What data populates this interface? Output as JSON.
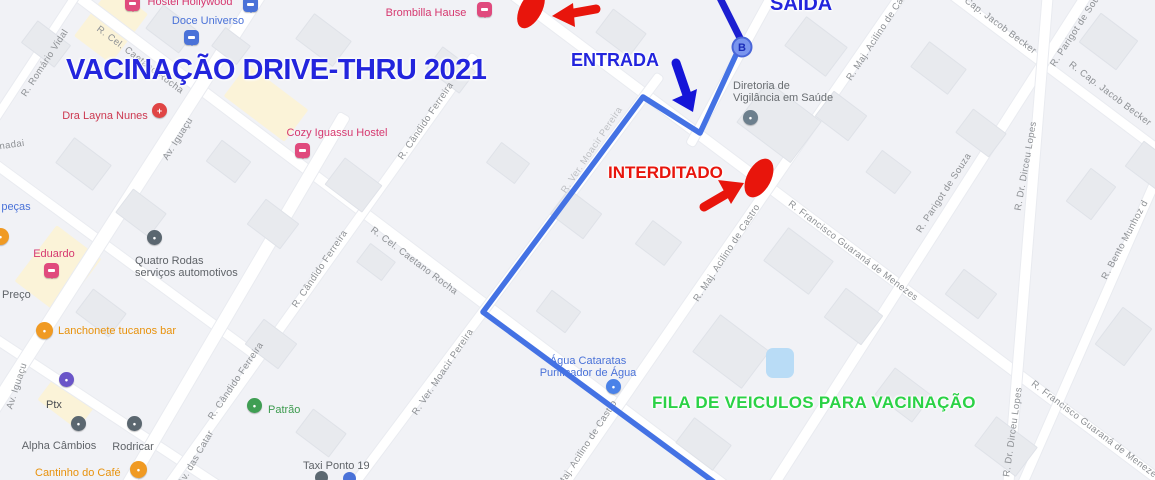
{
  "annotations": {
    "title": "VACINAÇÃO DRIVE-THRU 2021",
    "saida": "SAÍDA",
    "entrada": "ENTRADA",
    "interditado": "INTERDITADO",
    "fila": "FILA DE VEICULOS PARA VACINAÇÃO",
    "blue": "#2325dd",
    "red": "#e8150c",
    "green": "#2bd246"
  },
  "route": {
    "marker_label": "B",
    "marker_x": "742",
    "marker_y": "47",
    "dark_points": "718,-6 741,40",
    "light_points": "741,44 700,133 643,97 483,312 722,488",
    "dark_color": "#1c1fd1",
    "light_color": "#4472e4",
    "marker_fill": "#7a95ee",
    "marker_stroke": "#4a66d8",
    "marker_text_color": "#1b2cb8",
    "blue_arrow_shaft": "676,63 687,95",
    "blue_arrow_head": "693,112 672,100 697,89",
    "red_arrow1_shaft": "596,9 568,14",
    "red_arrow1_head": "552,16 573,3 575,27",
    "red_arrow2_shaft": "704,207 728,193",
    "red_arrow2_head": "744,183 718,180 731,204",
    "blob1_transform": "rotate(28 531 9)",
    "blob2_transform": "rotate(28 759 178)"
  },
  "streets": [
    {
      "label": "R. Romário Vidal",
      "x": 45,
      "y": 63,
      "rot": -57
    },
    {
      "label": "nadai",
      "x": 12,
      "y": 145,
      "rot": -8
    },
    {
      "label": "R. Cel. Caetano Rocha",
      "x": 140,
      "y": 60,
      "rot": 37
    },
    {
      "label": "R. Cel. Caetano Rocha",
      "x": 414,
      "y": 261,
      "rot": 37
    },
    {
      "label": "Av. Iguaçu",
      "x": 178,
      "y": 139,
      "rot": -58
    },
    {
      "label": "Av. Iguaçu",
      "x": 17,
      "y": 386,
      "rot": -72
    },
    {
      "label": "Av. das Catar",
      "x": 196,
      "y": 458,
      "rot": -60
    },
    {
      "label": "R. Cândido Ferreira",
      "x": 426,
      "y": 121,
      "rot": -56
    },
    {
      "label": "R. Cândido Ferreira",
      "x": 320,
      "y": 269,
      "rot": -56
    },
    {
      "label": "R. Cândido Ferreira",
      "x": 236,
      "y": 381,
      "rot": -56
    },
    {
      "label": "R. Ver. Moacir Pereira",
      "x": 443,
      "y": 372,
      "rot": -56
    },
    {
      "label": "R. Ver. Moacir Pereira",
      "x": 592,
      "y": 150,
      "rot": -56,
      "faint": true
    },
    {
      "label": "R. Maj. Acilino de Castro",
      "x": 880,
      "y": 32,
      "rot": -57
    },
    {
      "label": "R. Maj. Acilino de Castro",
      "x": 727,
      "y": 253,
      "rot": -57
    },
    {
      "label": "R. Maj. Acilino de Castro",
      "x": 584,
      "y": 449,
      "rot": -57
    },
    {
      "label": "R. Francisco Guaraná de Menezes",
      "x": 853,
      "y": 251,
      "rot": 37
    },
    {
      "label": "R. Francisco Guaraná de Menezes",
      "x": 1096,
      "y": 431,
      "rot": 37
    },
    {
      "label": "R. Parigot de Souza",
      "x": 1078,
      "y": 27,
      "rot": -57
    },
    {
      "label": "R. Parigot de Souza",
      "x": 944,
      "y": 193,
      "rot": -57
    },
    {
      "label": "R. Cap. Jacob Becker",
      "x": 995,
      "y": 22,
      "rot": 37
    },
    {
      "label": "R. Cap. Jacob Becker",
      "x": 1110,
      "y": 94,
      "rot": 37
    },
    {
      "label": "R. Dr. Dirceu Lopes",
      "x": 1026,
      "y": 166,
      "rot": -80
    },
    {
      "label": "R. Dr. Dirceu Lopes",
      "x": 1013,
      "y": 432,
      "rot": -82
    },
    {
      "label": "R. Bento Munhoz d",
      "x": 1125,
      "y": 240,
      "rot": -62
    }
  ],
  "pois": [
    {
      "name": "hostel-hollywood",
      "label": "Hostel Hollywood",
      "lx": 190,
      "ly": -4,
      "anchor": "c",
      "tc": "#d6386f",
      "pin": "sq",
      "px": 125,
      "py": -4,
      "pc": "#e04a7d"
    },
    {
      "name": "doce-universo",
      "label": "Doce Universo",
      "lx": 208,
      "ly": 15,
      "anchor": "c",
      "tc": "#4a72d8",
      "pin": "sq",
      "px": 184,
      "py": 30,
      "pc": "#4a72d8"
    },
    {
      "name": "blue-pin-top",
      "label": "",
      "lx": 0,
      "ly": 0,
      "anchor": "c",
      "tc": "#4a72d8",
      "pin": "sq",
      "px": 243,
      "py": -3,
      "pc": "#4a72d8"
    },
    {
      "name": "brombilla-hause",
      "label": "Brombilla Hause",
      "lx": 426,
      "ly": 7,
      "anchor": "c",
      "tc": "#d6386f",
      "pin": "sq",
      "px": 477,
      "py": 2,
      "pc": "#e04a7d"
    },
    {
      "name": "dra-layna-nunes",
      "label": "Dra Layna Nunes",
      "lx": 105,
      "ly": 110,
      "anchor": "c",
      "tc": "#cc3850",
      "pin": "drop",
      "px": 152,
      "py": 103,
      "pc": "#e04545",
      "glyph": "+"
    },
    {
      "name": "cozy-iguassu-hostel",
      "label": "Cozy Iguassu Hostel",
      "lx": 337,
      "ly": 127,
      "anchor": "c",
      "tc": "#d6386f",
      "pin": "sq",
      "px": 295,
      "py": 143,
      "pc": "#e04a7d"
    },
    {
      "name": "diretoria-vigilancia",
      "label": "Diretoria de",
      "label2": "Vigilância em Saúde",
      "lx": 733,
      "ly": 80,
      "anchor": "l",
      "tc": "#696d71",
      "pin": "drop",
      "px": 743,
      "py": 110,
      "pc": "#6c7f8d"
    },
    {
      "name": "eduardo",
      "label": "Eduardo",
      "lx": 54,
      "ly": 248,
      "anchor": "c",
      "tc": "#d6386f",
      "pin": "sq",
      "px": 44,
      "py": 263,
      "pc": "#e04a7d"
    },
    {
      "name": "quatro-rodas",
      "label": "Quatro Rodas",
      "label2": "serviços automotivos",
      "lx": 135,
      "ly": 255,
      "anchor": "l",
      "tc": "#5f6368",
      "pin": "drop",
      "px": 147,
      "py": 230,
      "pc": "#5b6770"
    },
    {
      "name": "pecas",
      "label": "peças",
      "lx": 16,
      "ly": 201,
      "anchor": "c",
      "tc": "#4a72d8"
    },
    {
      "name": "preco",
      "label": "Preço",
      "lx": 2,
      "ly": 289,
      "anchor": "l",
      "tc": "#5f6368"
    },
    {
      "name": "lanchonete-tucanos",
      "label": "Lanchonete tucanos bar",
      "lx": 58,
      "ly": 325,
      "anchor": "l",
      "tc": "#e8920c",
      "circle": true,
      "px": 36,
      "py": 322,
      "pc": "#f09a23"
    },
    {
      "name": "ptx",
      "label": "Ptx",
      "lx": 46,
      "ly": 399,
      "anchor": "l",
      "tc": "#494c50",
      "pin": "drop",
      "px": 59,
      "py": 372,
      "pc": "#6a55c8"
    },
    {
      "name": "alpha-cambios",
      "label": "Alpha Câmbios",
      "lx": 59,
      "ly": 440,
      "anchor": "c",
      "tc": "#5f6368",
      "pin": "drop",
      "px": 71,
      "py": 416,
      "pc": "#5b6770"
    },
    {
      "name": "rodricar",
      "label": "Rodricar",
      "lx": 133,
      "ly": 441,
      "anchor": "c",
      "tc": "#5f6368",
      "pin": "drop",
      "px": 127,
      "py": 416,
      "pc": "#5b6770"
    },
    {
      "name": "cantinho-do-cafe",
      "label": "Cantinho do Café",
      "lx": 35,
      "ly": 467,
      "anchor": "l",
      "tc": "#e8920c",
      "circle": true,
      "px": 130,
      "py": 461,
      "pc": "#f09a23"
    },
    {
      "name": "patrao",
      "label": "Patrão",
      "lx": 268,
      "ly": 404,
      "anchor": "l",
      "tc": "#3d9b4f",
      "pin": "drop",
      "px": 247,
      "py": 398,
      "pc": "#3f9e53"
    },
    {
      "name": "agua-cataratas",
      "label": "Água Cataratas",
      "label2": "Purificador de Água",
      "lx": 588,
      "ly": 355,
      "anchor": "cm",
      "tc": "#4a72d8",
      "pin": "drop",
      "px": 606,
      "py": 379,
      "pc": "#4a82e8"
    },
    {
      "name": "taxi-ponto-19",
      "label": "Taxi Ponto 19",
      "lx": 303,
      "ly": 460,
      "anchor": "l",
      "tc": "#5f6368"
    },
    {
      "name": "orange-poi-partial",
      "label": "",
      "lx": 0,
      "ly": 0,
      "anchor": "l",
      "tc": "#e8920c",
      "circle": true,
      "px": -8,
      "py": 228,
      "pc": "#f09a23"
    }
  ],
  "dots": [
    {
      "name": "taxi-dot-1",
      "x": 315,
      "y": 471,
      "r": 13,
      "c": "#5b6770"
    },
    {
      "name": "taxi-dot-2",
      "x": 343,
      "y": 472,
      "r": 13,
      "c": "#4a72d8"
    }
  ],
  "map": {
    "roads": [
      {
        "cx": 400,
        "cy": 240,
        "len": 828,
        "w": 10,
        "rot": 37.1
      },
      {
        "cx": 835,
        "cy": 237,
        "len": 825,
        "w": 10,
        "rot": 36.9
      },
      {
        "cx": 1055,
        "cy": 72,
        "len": 275,
        "w": 9,
        "rot": 36.9
      },
      {
        "cx": 107,
        "cy": 412,
        "len": 281,
        "w": 9,
        "rot": 33.4
      },
      {
        "cx": 122,
        "cy": 257,
        "len": 329,
        "w": 9,
        "rot": 36.3
      },
      {
        "cx": 32,
        "cy": 62,
        "len": 173,
        "w": 8,
        "rot": 123.2
      },
      {
        "cx": 121,
        "cy": 210,
        "len": 522,
        "w": 13,
        "rot": 122.7
      },
      {
        "cx": 235,
        "cy": 302,
        "len": 434,
        "w": 12,
        "rot": 120.4
      },
      {
        "cx": 320,
        "cy": 272,
        "len": 534,
        "w": 9,
        "rot": 125.5
      },
      {
        "cx": 505,
        "cy": 282,
        "len": 518,
        "w": 9,
        "rot": 126.8
      },
      {
        "cx": 732,
        "cy": 240,
        "len": 607,
        "w": 10,
        "rot": 124.6
      },
      {
        "cx": 732,
        "cy": 67,
        "len": 177,
        "w": 9,
        "rot": 118.7
      },
      {
        "cx": 930,
        "cy": 240,
        "len": 594,
        "w": 10,
        "rot": 122.6
      },
      {
        "cx": 1028,
        "cy": 240,
        "len": 502,
        "w": 10,
        "rot": 94.6
      },
      {
        "cx": 1092,
        "cy": 325,
        "len": 360,
        "w": 9,
        "rot": 113.7
      }
    ],
    "yellow_zones": [
      {
        "x": 88,
        "y": -6,
        "w": 46,
        "h": 62,
        "rot": 37
      },
      {
        "x": 228,
        "y": 83,
        "w": 76,
        "h": 40,
        "rot": 37
      },
      {
        "x": 30,
        "y": 235,
        "w": 56,
        "h": 70,
        "rot": 37
      },
      {
        "x": 42,
        "y": 386,
        "w": 50,
        "h": 32,
        "rot": 37
      }
    ],
    "buildings": [
      {
        "x": 150,
        "y": 14,
        "w": 40,
        "h": 28,
        "rot": 37
      },
      {
        "x": 215,
        "y": 34,
        "w": 30,
        "h": 22,
        "rot": 37
      },
      {
        "x": 300,
        "y": 24,
        "w": 45,
        "h": 30,
        "rot": 37
      },
      {
        "x": 430,
        "y": 56,
        "w": 40,
        "h": 26,
        "rot": 37
      },
      {
        "x": 600,
        "y": 18,
        "w": 40,
        "h": 28,
        "rot": 37
      },
      {
        "x": 790,
        "y": 28,
        "w": 50,
        "h": 35,
        "rot": 37
      },
      {
        "x": 915,
        "y": 52,
        "w": 45,
        "h": 30,
        "rot": 37
      },
      {
        "x": 1090,
        "y": 18,
        "w": 35,
        "h": 45,
        "rot": -53
      },
      {
        "x": 1130,
        "y": 150,
        "w": 40,
        "h": 30,
        "rot": 37
      },
      {
        "x": 60,
        "y": 148,
        "w": 45,
        "h": 30,
        "rot": 37
      },
      {
        "x": 120,
        "y": 198,
        "w": 40,
        "h": 28,
        "rot": 37
      },
      {
        "x": 210,
        "y": 148,
        "w": 35,
        "h": 25,
        "rot": 37
      },
      {
        "x": 252,
        "y": 208,
        "w": 40,
        "h": 30,
        "rot": 37
      },
      {
        "x": 330,
        "y": 168,
        "w": 45,
        "h": 32,
        "rot": 37
      },
      {
        "x": 555,
        "y": 198,
        "w": 40,
        "h": 30,
        "rot": 37
      },
      {
        "x": 640,
        "y": 228,
        "w": 35,
        "h": 28,
        "rot": 37
      },
      {
        "x": 745,
        "y": 96,
        "w": 66,
        "h": 50,
        "rot": 37
      },
      {
        "x": 770,
        "y": 240,
        "w": 55,
        "h": 40,
        "rot": 37
      },
      {
        "x": 830,
        "y": 298,
        "w": 45,
        "h": 35,
        "rot": 37
      },
      {
        "x": 950,
        "y": 278,
        "w": 40,
        "h": 30,
        "rot": 37
      },
      {
        "x": 1070,
        "y": 178,
        "w": 40,
        "h": 30,
        "rot": -53
      },
      {
        "x": 1100,
        "y": 318,
        "w": 45,
        "h": 35,
        "rot": -53
      },
      {
        "x": 80,
        "y": 298,
        "w": 40,
        "h": 28,
        "rot": 37
      },
      {
        "x": 250,
        "y": 328,
        "w": 40,
        "h": 30,
        "rot": 37
      },
      {
        "x": 540,
        "y": 298,
        "w": 35,
        "h": 25,
        "rot": 37
      },
      {
        "x": 700,
        "y": 328,
        "w": 60,
        "h": 45,
        "rot": 37
      },
      {
        "x": 880,
        "y": 378,
        "w": 45,
        "h": 32,
        "rot": 37
      },
      {
        "x": 960,
        "y": 118,
        "w": 40,
        "h": 28,
        "rot": 37
      },
      {
        "x": 820,
        "y": 100,
        "w": 40,
        "h": 30,
        "rot": 37
      },
      {
        "x": 870,
        "y": 158,
        "w": 35,
        "h": 26,
        "rot": 37
      },
      {
        "x": 300,
        "y": 418,
        "w": 40,
        "h": 28,
        "rot": 37
      },
      {
        "x": 680,
        "y": 428,
        "w": 45,
        "h": 30,
        "rot": 37
      },
      {
        "x": 980,
        "y": 428,
        "w": 50,
        "h": 35,
        "rot": 37
      },
      {
        "x": 360,
        "y": 250,
        "w": 30,
        "h": 22,
        "rot": 37
      },
      {
        "x": 490,
        "y": 150,
        "w": 34,
        "h": 24,
        "rot": 37
      },
      {
        "x": 25,
        "y": 30,
        "w": 40,
        "h": 26,
        "rot": 37
      }
    ],
    "pond": {
      "x": 766,
      "y": 348,
      "w": 28,
      "h": 30
    }
  }
}
